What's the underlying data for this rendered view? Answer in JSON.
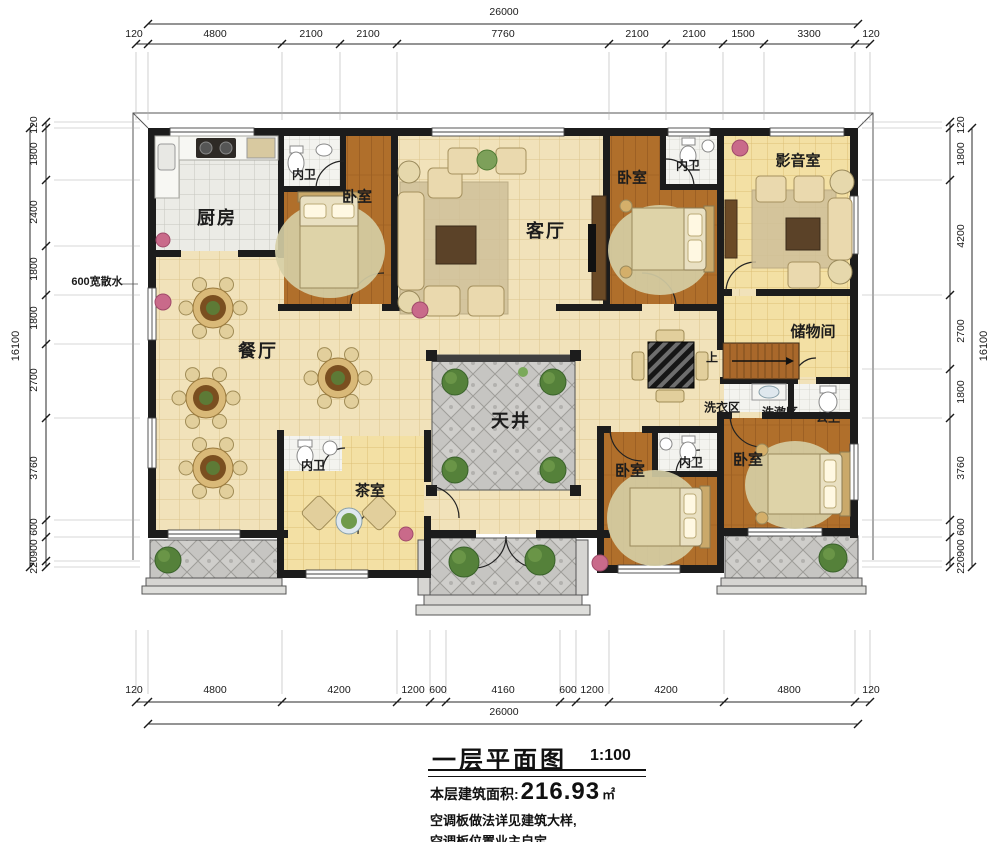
{
  "title": {
    "name": "一层平面图",
    "scale": "1:100",
    "area_label": "本层建筑面积:",
    "area_value": "216.93",
    "area_unit": "㎡",
    "note1": "空调板做法详见建筑大样,",
    "note2": "空调板位置业主自定"
  },
  "dims": {
    "top_total": "26000",
    "top": [
      "120",
      "4800",
      "2100",
      "2100",
      "7760",
      "2100",
      "2100",
      "1500",
      "3300",
      "120"
    ],
    "bottom": [
      "120",
      "4800",
      "4200",
      "1200",
      "600",
      "4160",
      "600",
      "1200",
      "4200",
      "4800",
      "120"
    ],
    "bottom_total": "26000",
    "left_total": "16100",
    "left": [
      "120",
      "1800",
      "2400",
      "1800",
      "1800",
      "2700",
      "3760",
      "600",
      "900",
      "220"
    ],
    "right": [
      "120",
      "1800",
      "4200",
      "2700",
      "1800",
      "3760",
      "600",
      "900",
      "220"
    ],
    "right_total": "16100",
    "apron": "600宽散水"
  },
  "rooms": {
    "kitchen": "厨房",
    "dining": "餐厅",
    "living": "客厅",
    "courtyard": "天井",
    "media": "影音室",
    "storage": "储物间",
    "tea": "茶室",
    "bedroom": "卧室",
    "ensuite": "内卫",
    "laundry": "洗衣区",
    "wash": "洗漱区",
    "public_bath": "公卫",
    "up": "上"
  },
  "palette": {
    "wall": "#1c1c1c",
    "floor_tile": "#f1e2ba",
    "floor_wood": "#b06f2b",
    "floor_yellow": "#f3e0a4",
    "pavement": "#c6c5c2",
    "bath_tile": "#f3f3ef",
    "rug": "#cfc09a",
    "greenery": "#55813a",
    "flower_pink": "#c96a8a"
  }
}
